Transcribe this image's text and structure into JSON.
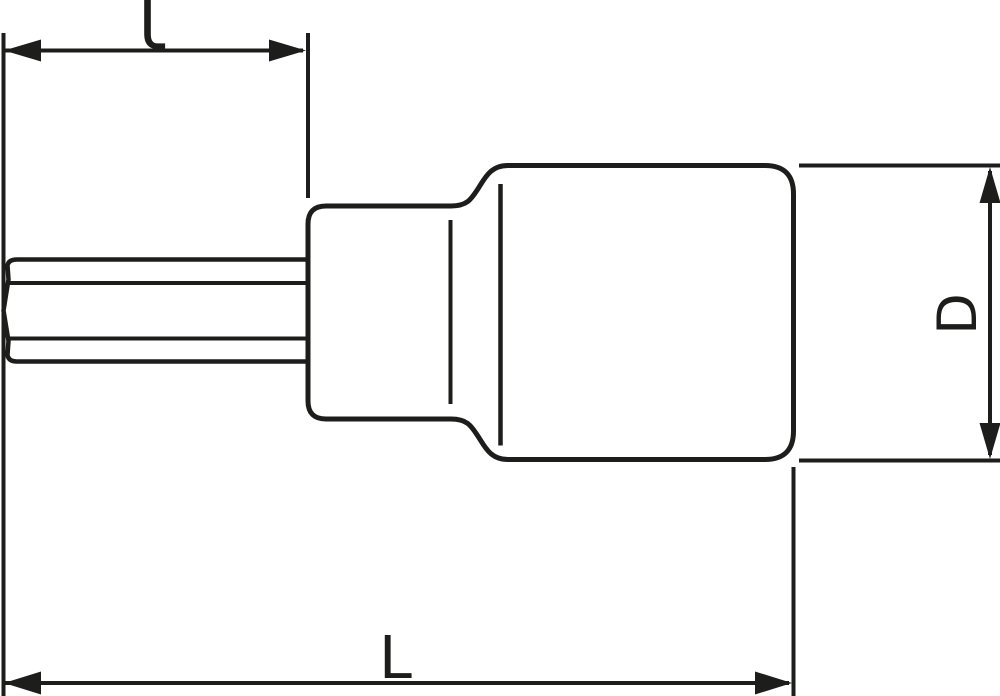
{
  "colors": {
    "stroke": "#1d1d1b",
    "background": "#ffffff"
  },
  "labels": {
    "insert_length": "l",
    "diameter": "D",
    "overall_length": "L"
  }
}
